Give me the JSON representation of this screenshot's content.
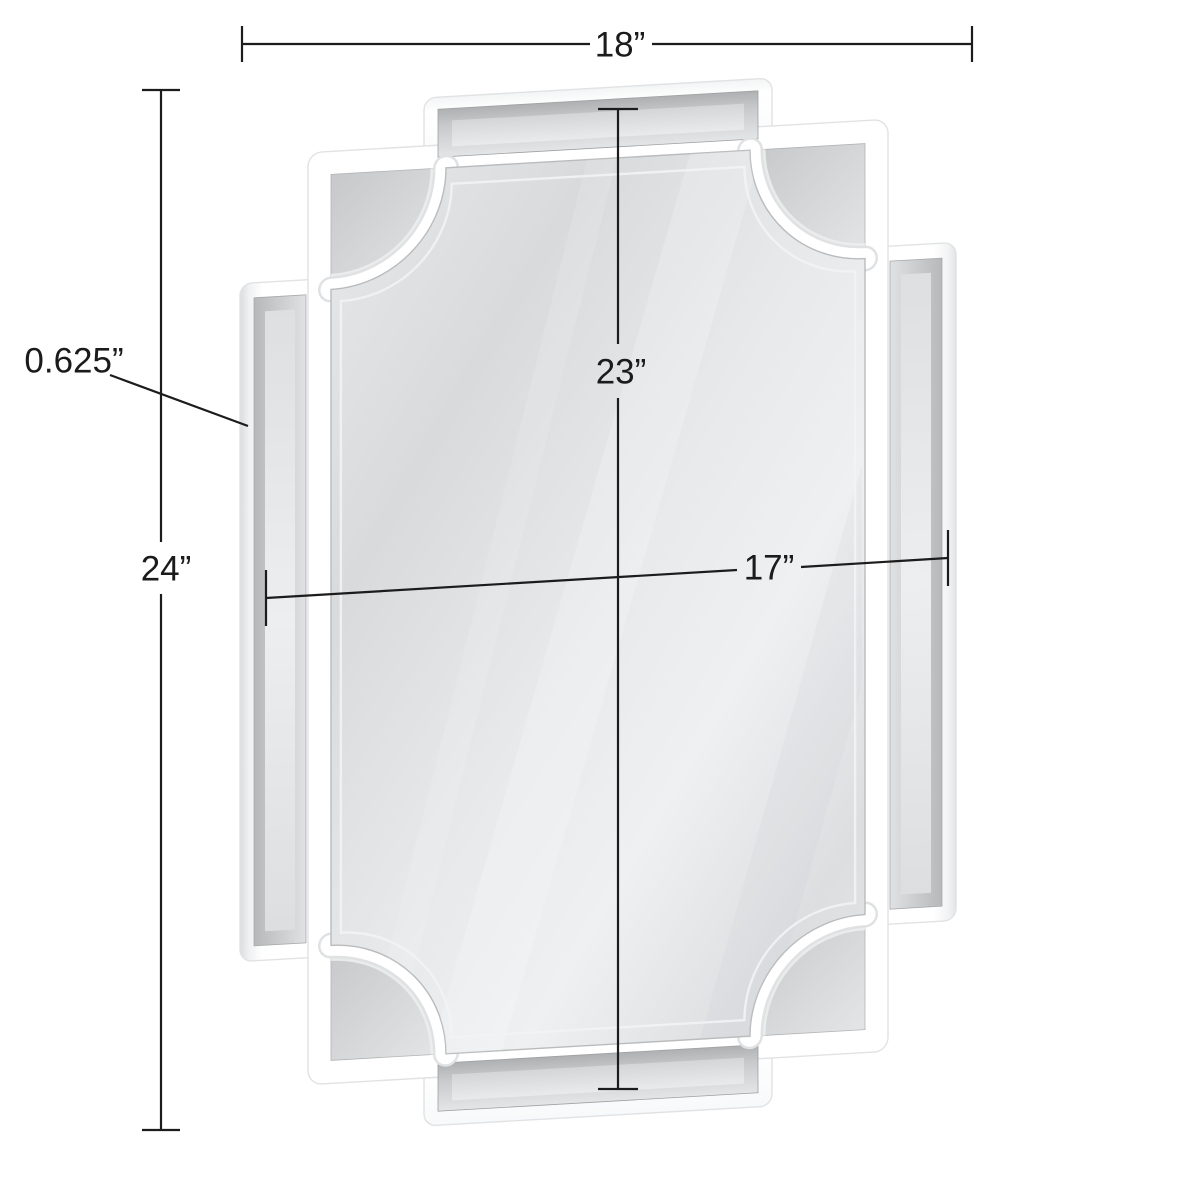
{
  "page": {
    "type": "product-dimension-diagram",
    "subject": "white scalloped-corner wall mirror with beveled mirror frame panels",
    "background": "#ffffff"
  },
  "dimensions": {
    "overall_width": {
      "label": "18”",
      "inches": 18
    },
    "overall_height": {
      "label": "24”",
      "inches": 24
    },
    "mirror_height": {
      "label": "23”",
      "inches": 23
    },
    "mirror_width": {
      "label": "17”",
      "inches": 17
    },
    "frame_depth": {
      "label": "0.625”",
      "inches": 0.625
    }
  },
  "colors": {
    "annotation_line": "#1c1c1c",
    "annotation_text": "#1b1b1b",
    "frame_white": "#ffffff",
    "glass_light": "#eceeef",
    "glass_dark": "#d7d9db",
    "bevel_gray": "#c2c4c6",
    "background": "#ffffff"
  }
}
